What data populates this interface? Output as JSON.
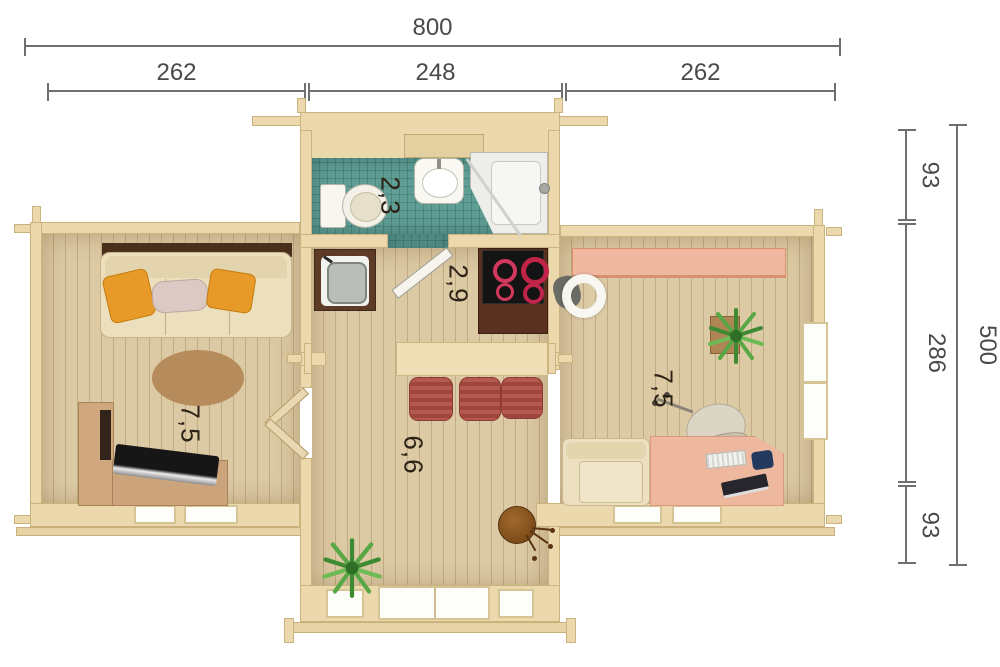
{
  "plan": {
    "dims": {
      "top_total": "800",
      "top_segments": [
        "262",
        "248",
        "262"
      ],
      "right_segments": [
        "93",
        "286",
        "93"
      ],
      "right_total": "500"
    },
    "rooms": {
      "living": "7,5",
      "bathroom": "2,3",
      "kitchen": "2,9",
      "hall": "6,6",
      "office": "7,5"
    },
    "colors": {
      "wall": "#ebd9ad",
      "floor": "#dccaa4",
      "bath_tile": "#5f9e95",
      "stool_red": "#b65a50",
      "pillow_orange": "#e79a28",
      "desk_pink": "#eeb89e",
      "shelf_pink": "#f0b89e",
      "plant_green": "#4f9c3c",
      "rug_brown": "#b78c5c",
      "dim_line": "#6f6f6f"
    }
  }
}
